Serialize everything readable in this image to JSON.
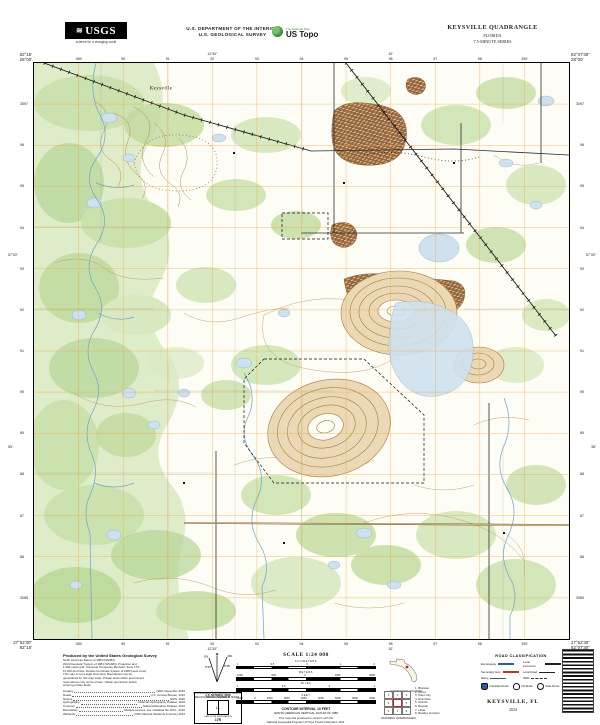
{
  "header": {
    "usgs_logo_text": "USGS",
    "usgs_tagline": "science for a changing world",
    "dept_line1": "U.S. DEPARTMENT OF THE INTERIOR",
    "dept_line2": "U.S. GEOLOGICAL SURVEY",
    "ustopo_tagline": "The National Map",
    "ustopo_title": "US Topo",
    "quad_title": "KEYSVILLE QUADRANGLE",
    "quad_state": "FLORIDA",
    "quad_series": "7.5-MINUTE SERIES"
  },
  "collar": {
    "corner_tl_lon": "82°15'",
    "corner_tl_lat": "28°00'",
    "corner_tr_lon": "82°07'30\"",
    "corner_tr_lat": "28°00'",
    "corner_bl_lon": "82°15'",
    "corner_bl_lat": "27°52'30\"",
    "corner_br_lon": "82°07'30\"",
    "corner_br_lat": "27°52'30\"",
    "top_minutes": [
      "12'30\"",
      "10'"
    ],
    "bottom_minutes": [
      "12'30\"",
      "10'"
    ],
    "left_minutes": [
      "57'30\"",
      "55'"
    ],
    "right_minutes": [
      "57'30\"",
      "55'"
    ],
    "top_eastings": [
      "389",
      "90",
      "91",
      "92",
      "93",
      "94",
      "95",
      "96",
      "97",
      "98",
      "399"
    ],
    "bottom_eastings": [
      "389",
      "90",
      "91",
      "92",
      "93",
      "94",
      "95",
      "96",
      "97",
      "98",
      "399"
    ],
    "left_northings": [
      "3097",
      "96",
      "95",
      "94",
      "93",
      "92",
      "91",
      "90",
      "89",
      "88",
      "87",
      "86",
      "3085"
    ],
    "right_northings": [
      "3097",
      "96",
      "95",
      "94",
      "93",
      "92",
      "91",
      "90",
      "89",
      "88",
      "87",
      "86",
      "3085"
    ]
  },
  "map_labels": [
    {
      "text": "Keysville",
      "x": 127,
      "y": 26
    }
  ],
  "footer": {
    "produced_by": "Produced by the United States Geological Survey",
    "fineprint": [
      "North American Datum of 1983 (NAD83)",
      "World Geodetic System of 1984 (WGS84). Projection and",
      "1 000-meter grid: Universal Transverse Mercator, Zone 17N",
      "10 000-foot ticks: Florida Coordinate System of 1983 (west zone)",
      "This map is not a legal document. Boundaries may be",
      "generalized for this map scale. Private lands within government",
      "reservations may not be shown. Obtain permission before",
      "entering private lands."
    ],
    "credits": [
      {
        "label": "Imagery",
        "value": "NAIP, December 2019"
      },
      {
        "label": "Roads",
        "value": "U.S. Census Bureau, 2016"
      },
      {
        "label": "Names",
        "value": "GNIS, 2020"
      },
      {
        "label": "Hydrography",
        "value": "National Hydrography Dataset, 2016"
      },
      {
        "label": "Contours",
        "value": "National Elevation Dataset, 2012"
      },
      {
        "label": "Boundaries",
        "value": "Multiple sources; see metadata file 1972 - 2016"
      },
      {
        "label": "Wetlands",
        "value": "FWS National Wetlands Inventory 2014"
      }
    ],
    "declination": {
      "gn_label": "GN",
      "mn_label": "MN",
      "gn_value": "0°33'",
      "mn_value": "6°45'",
      "caption1": "UTM GRID AND 2020 MAGNETIC NORTH",
      "caption2": "DECLINATION AT CENTER OF SHEET"
    },
    "usng": {
      "title": "U.S. NATIONAL GRID",
      "subtitle": "100,000-m SQUARE ID",
      "square_id": "LL",
      "gzd_label": "GRID ZONE DESIGNATION",
      "gzd": "17R"
    },
    "scale": {
      "title": "SCALE 1:24 000",
      "rows": [
        {
          "name": "KILOMETERS",
          "ticks": [
            "1",
            "0.5",
            "0",
            "1",
            "2"
          ]
        },
        {
          "name": "METERS",
          "ticks": [
            "1000",
            "500",
            "0",
            "1000",
            "2000"
          ]
        },
        {
          "name": "MILES",
          "ticks": [
            "1",
            "0.5",
            "0",
            "1"
          ]
        },
        {
          "name": "FEET",
          "ticks": [
            "1000",
            "0",
            "1000",
            "2000",
            "3000",
            "4000",
            "5000",
            "6000",
            "7000"
          ]
        }
      ]
    },
    "contour_line1": "CONTOUR INTERVAL 10 FEET",
    "contour_line2": "NORTH AMERICAN VERTICAL DATUM OF 1988",
    "standard_line1": "This map was produced to conform with the",
    "standard_line2": "National Geospatial Program US Topo Product Standard, 2011.",
    "locator_caption": "QUADRANGLE LOCATION",
    "adjoining": {
      "caption": "ADJOINING QUADRANGLES",
      "grid": [
        "1",
        "2",
        "3",
        "4",
        "",
        "5",
        "6",
        "7",
        "8"
      ],
      "quads": [
        "Brandon",
        "Dover",
        "Plant City",
        "Riverview",
        "Nichols",
        "Boyette",
        "Lithia",
        "Bradley Junction"
      ]
    },
    "road_class": {
      "title": "ROAD CLASSIFICATION",
      "rows": [
        {
          "label": "Expressway",
          "style": "rc-expressway"
        },
        {
          "label": "Local Connector",
          "style": "rc-connector"
        },
        {
          "label": "Secondary Hwy",
          "style": "rc-secondary"
        },
        {
          "label": "Local Road",
          "style": "rc-local"
        },
        {
          "label": "Ramp",
          "style": "rc-ramp"
        },
        {
          "label": "4WD",
          "style": "rc-4wd"
        }
      ],
      "shields": [
        {
          "label": "Interstate Route",
          "type": "interstate"
        },
        {
          "label": "US Route",
          "type": "us"
        },
        {
          "label": "State Route",
          "type": "state"
        }
      ]
    },
    "title_block": {
      "name": "KEYSVILLE, FL",
      "year": "2024"
    }
  },
  "colors": {
    "paper": "#fdfcf5",
    "vegetation_light": "#d8e9c2",
    "vegetation_mid": "#cbe2ae",
    "vegetation_dark": "#b6d697",
    "water_fill": "#cfe1ef",
    "water_line": "#6fa3cc",
    "contour_brown": "#c49a62",
    "mine_brown": "#96653a",
    "utm_grid_orange": "#eaa63e",
    "rail_black": "#1a1a1a",
    "locator_red": "#c0272d",
    "interstate_blue": "#2a5d9f",
    "ustopo_green": "#3f8f46"
  }
}
